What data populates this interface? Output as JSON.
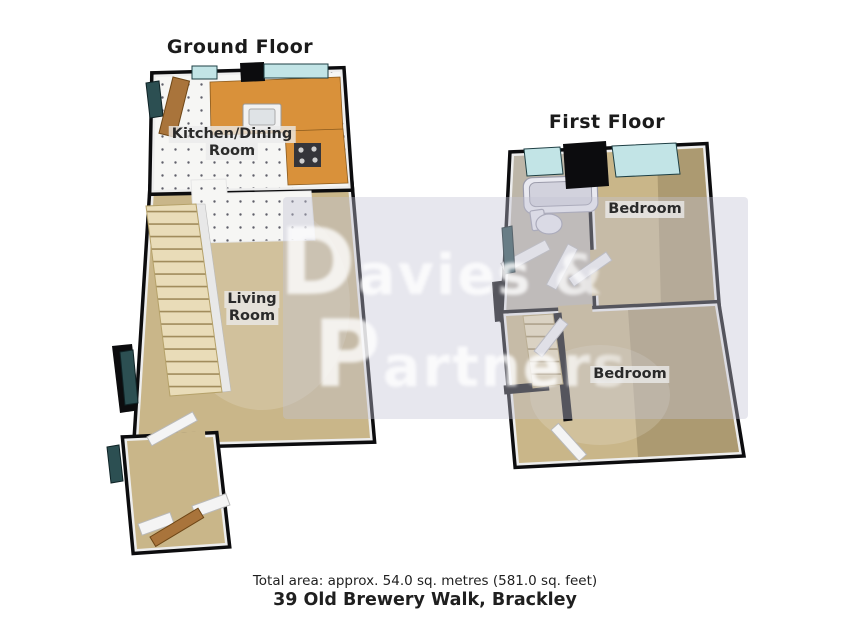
{
  "ground_floor": {
    "title": "Ground Floor",
    "rooms": {
      "kitchen_dining": {
        "line1": "Kitchen/Dining",
        "line2": "Room"
      },
      "living": {
        "line1": "Living",
        "line2": "Room"
      }
    }
  },
  "first_floor": {
    "title": "First Floor",
    "rooms": {
      "bedroom_top": {
        "label": "Bedroom"
      },
      "bedroom_bottom": {
        "label": "Bedroom"
      }
    }
  },
  "watermark": {
    "line1": "Davies &",
    "line2": "Partners"
  },
  "footer": {
    "total_area": "Total area: approx. 54.0 sq. metres (581.0 sq. feet)",
    "address": "39 Old Brewery Walk, Brackley"
  },
  "colors": {
    "wall_black": "#0c0c0e",
    "floor_tan": "#c9b689",
    "floor_tan_dark": "#8a7754",
    "bathroom_floor": "#bdb6a8",
    "kitchen_counter": "#d9913a",
    "stair_beige": "#e9dcb8",
    "door_wood": "#a9743b",
    "window_teal_light": "#c2e4e6",
    "window_teal_dark": "#2c4f52",
    "watermark_band": "#c3c3d4"
  }
}
